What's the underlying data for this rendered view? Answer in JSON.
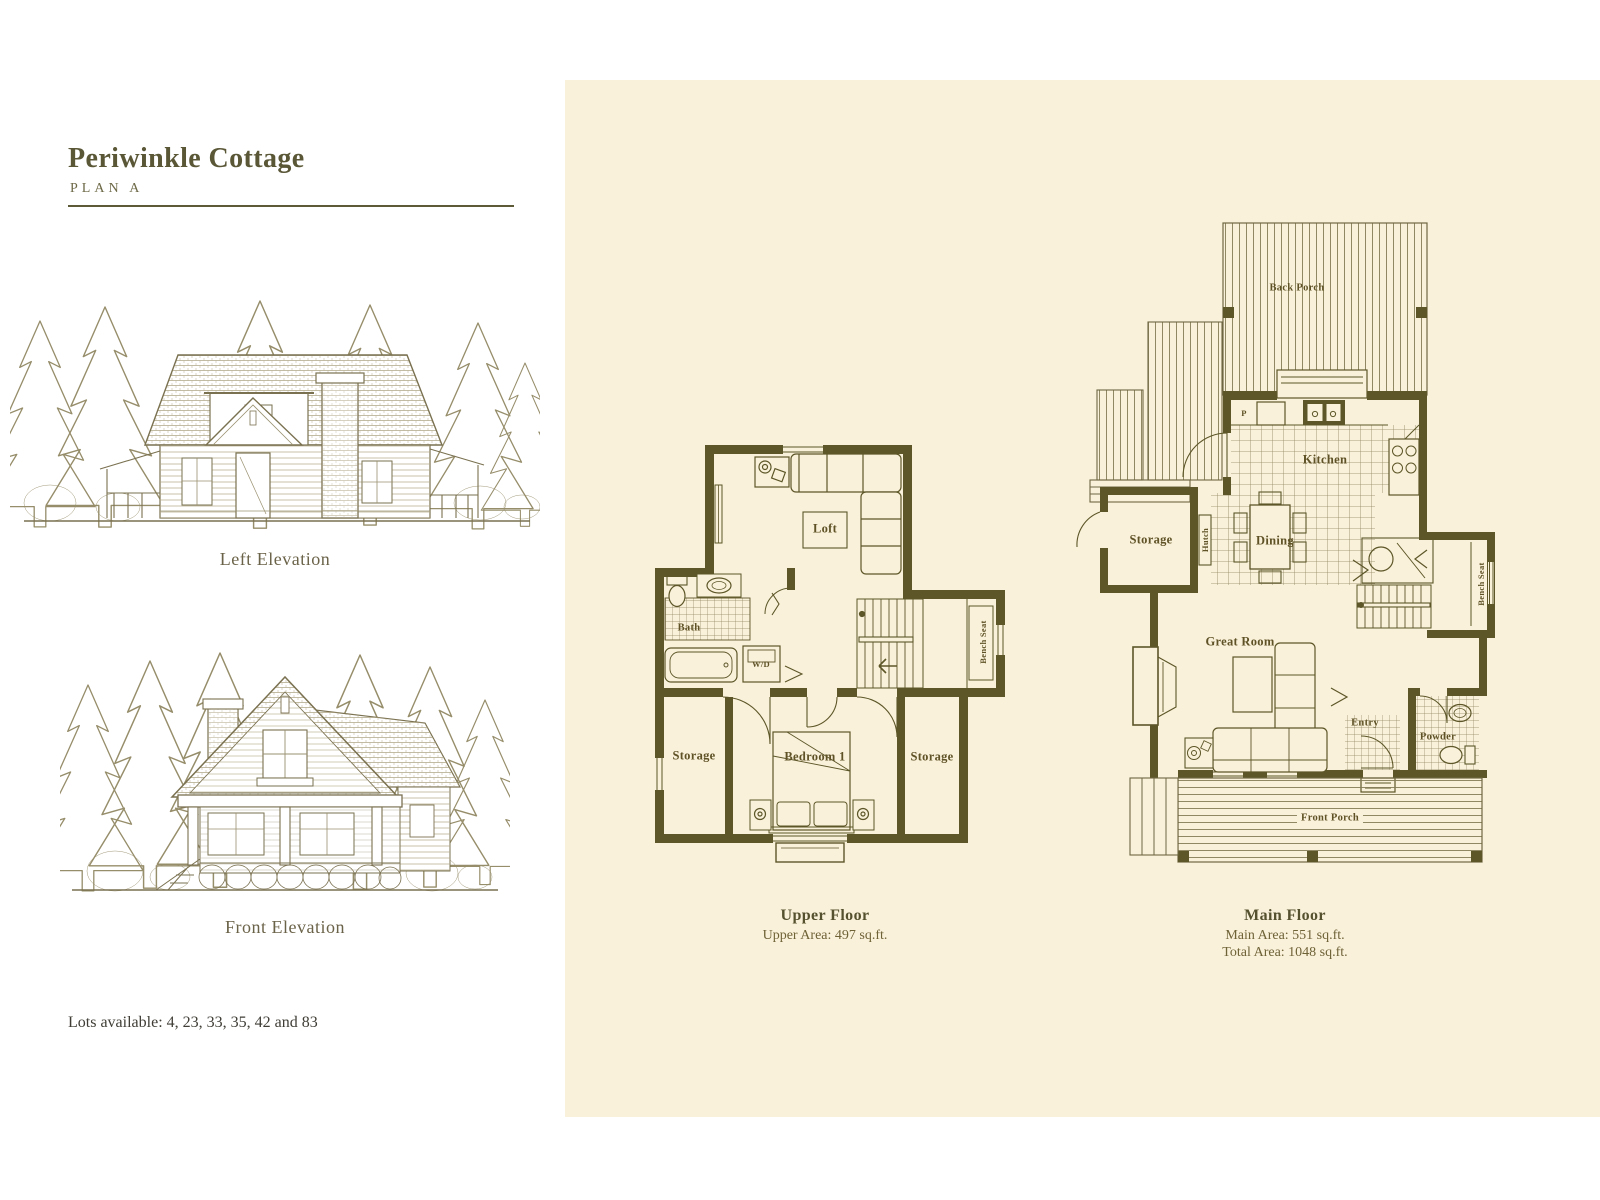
{
  "header": {
    "title": "Periwinkle Cottage",
    "subtitle": "PLAN A"
  },
  "figures": {
    "left_elevation_caption": "Left Elevation",
    "front_elevation_caption": "Front Elevation"
  },
  "lots": {
    "text": "Lots available: 4, 23, 33, 35, 42 and 83"
  },
  "upper_floor": {
    "title": "Upper Floor",
    "area": "Upper Area: 497 sq.ft.",
    "rooms": {
      "loft": "Loft",
      "bath": "Bath",
      "wd": "W/D",
      "bench_seat": "Bench Seat",
      "storage_left": "Storage",
      "bedroom": "Bedroom 1",
      "storage_right": "Storage"
    }
  },
  "main_floor": {
    "title": "Main Floor",
    "area_main": "Main Area: 551 sq.ft.",
    "area_total": "Total Area: 1048 sq.ft.",
    "rooms": {
      "back_porch": "Back Porch",
      "pantry": "P",
      "kitchen": "Kitchen",
      "hutch": "Hutch",
      "dining": "Dining",
      "storage": "Storage",
      "bench_seat": "Bench Seat",
      "great_room": "Great Room",
      "entry": "Entry",
      "powder": "Powder",
      "front_porch": "Front Porch"
    }
  },
  "colors": {
    "panel_bg": "#faf1da",
    "plan_ink": "#5c5628",
    "sketch_ink": "#8d8565",
    "title_ink": "#5a5737",
    "body_text": "#3f3d35"
  }
}
